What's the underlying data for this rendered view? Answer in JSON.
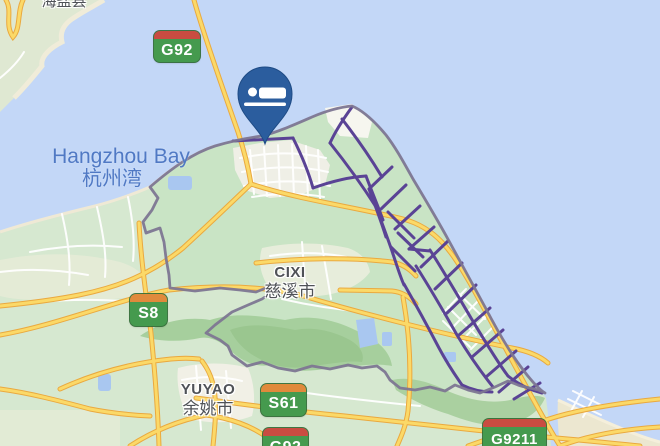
{
  "map": {
    "labels": {
      "sea_en": "Hangzhou Bay",
      "sea_zh": "杭州湾",
      "county_haiyan": "海盐县",
      "city_cixi_en": "CIXI",
      "city_cixi_zh": "慈溪市",
      "city_yuyao_en": "YUYAO",
      "city_yuyao_zh": "余姚市"
    },
    "route_badges": {
      "g92_top": "G92",
      "s8": "S8",
      "s61": "S61",
      "g92_bottom": "G92",
      "g9211": "G9211"
    },
    "marker": {
      "type": "lodging",
      "color": "#2b5d9e"
    },
    "colors": {
      "water": "#c3d7f7",
      "land": "#d6e8d0",
      "district_fill": "#c9e4c5",
      "hills": "#a6cf9d",
      "road_fill": "#fbd968",
      "road_casing": "#eaa93f",
      "street_highlight": "#5a4395",
      "district_boundary": "#7d7692",
      "badge_green": "#459a4e",
      "badge_red": "#c94c41",
      "badge_orange": "#e08a3c"
    }
  }
}
